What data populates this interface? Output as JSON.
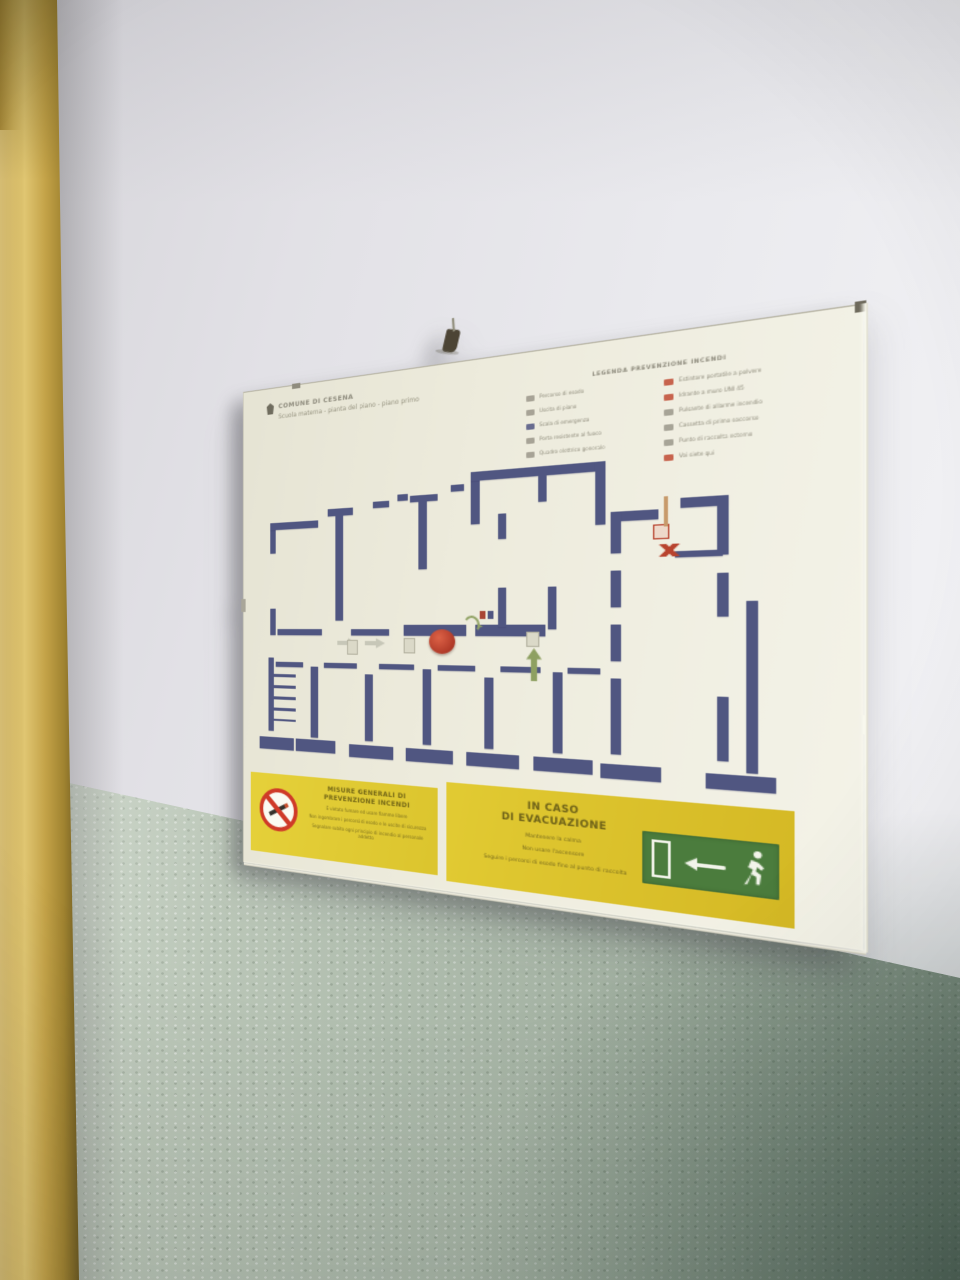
{
  "poster": {
    "title_line1": "COMUNE DI CESENA",
    "title_line2": "Scuola materna - pianta del piano - piano primo"
  },
  "legend": {
    "header": "LEGENDA PREVENZIONE INCENDI",
    "left_items": [
      {
        "label": "Percorso di esodo",
        "color": "#9a978a"
      },
      {
        "label": "Uscita di piano",
        "color": "#9a978a"
      },
      {
        "label": "Scala di emergenza",
        "color": "#505681"
      },
      {
        "label": "Porta resistente al fuoco",
        "color": "#9a978a"
      },
      {
        "label": "Quadro elettrico generale",
        "color": "#9a978a"
      }
    ],
    "right_items": [
      {
        "label": "Estintore portatile a polvere",
        "color": "#bf4a33"
      },
      {
        "label": "Idrante a muro UNI 45",
        "color": "#bf4a33"
      },
      {
        "label": "Pulsante di allarme incendio",
        "color": "#9a978a"
      },
      {
        "label": "Cassetta di primo soccorso",
        "color": "#9a978a"
      },
      {
        "label": "Punto di raccolta esterno",
        "color": "#9a978a"
      },
      {
        "label": "Voi siete qui",
        "color": "#bf4a33"
      }
    ]
  },
  "plan": {
    "wall_color": "#505681",
    "walls": [
      [
        14,
        36,
        6,
        30
      ],
      [
        14,
        36,
        52,
        7
      ],
      [
        76,
        26,
        26,
        7
      ],
      [
        84,
        32,
        8,
        100
      ],
      [
        122,
        22,
        16,
        6
      ],
      [
        146,
        17,
        10,
        6
      ],
      [
        158,
        19,
        26,
        6
      ],
      [
        166,
        24,
        8,
        62
      ],
      [
        196,
        12,
        12,
        6
      ],
      [
        214,
        2,
        8,
        46
      ],
      [
        214,
        2,
        112,
        8
      ],
      [
        318,
        2,
        8,
        52
      ],
      [
        238,
        40,
        7,
        22
      ],
      [
        272,
        10,
        7,
        22
      ],
      [
        14,
        120,
        6,
        26
      ],
      [
        22,
        140,
        48,
        6
      ],
      [
        100,
        140,
        38,
        6
      ],
      [
        152,
        136,
        58,
        10
      ],
      [
        218,
        136,
        60,
        10
      ],
      [
        238,
        104,
        7,
        34
      ],
      [
        280,
        104,
        7,
        36
      ],
      [
        12,
        168,
        6,
        72
      ],
      [
        2,
        246,
        38,
        12
      ],
      [
        58,
        176,
        8,
        68
      ],
      [
        42,
        246,
        42,
        12
      ],
      [
        114,
        182,
        8,
        62
      ],
      [
        98,
        248,
        44,
        12
      ],
      [
        170,
        176,
        8,
        68
      ],
      [
        154,
        248,
        44,
        12
      ],
      [
        226,
        182,
        8,
        62
      ],
      [
        210,
        248,
        46,
        12
      ],
      [
        284,
        176,
        8,
        68
      ],
      [
        268,
        248,
        48,
        12
      ],
      [
        20,
        172,
        30,
        5
      ],
      [
        72,
        172,
        34,
        5
      ],
      [
        128,
        172,
        34,
        5
      ],
      [
        184,
        172,
        34,
        5
      ],
      [
        240,
        172,
        34,
        5
      ],
      [
        296,
        172,
        26,
        5
      ],
      [
        330,
        44,
        36,
        8
      ],
      [
        330,
        44,
        8,
        34
      ],
      [
        382,
        36,
        34,
        8
      ],
      [
        408,
        36,
        8,
        46
      ],
      [
        330,
        92,
        8,
        30
      ],
      [
        408,
        96,
        8,
        34
      ],
      [
        330,
        136,
        8,
        30
      ],
      [
        378,
        78,
        34,
        5
      ],
      [
        330,
        180,
        8,
        62
      ],
      [
        322,
        250,
        46,
        12
      ],
      [
        408,
        192,
        8,
        50
      ],
      [
        400,
        252,
        48,
        12
      ],
      [
        428,
        118,
        8,
        132
      ]
    ],
    "symbols": [
      {
        "type": "arrow-right",
        "x": 86,
        "y": 148,
        "w": 20,
        "h": 10
      },
      {
        "type": "arrow-right",
        "x": 114,
        "y": 148,
        "w": 20,
        "h": 10
      },
      {
        "type": "red-badge",
        "x": 176,
        "y": 140,
        "w": 24,
        "h": 22
      },
      {
        "type": "curve-arrow",
        "x": 208,
        "y": 128,
        "w": 14,
        "h": 16
      },
      {
        "type": "up-arrow",
        "x": 262,
        "y": 156,
        "w": 13,
        "h": 28
      },
      {
        "type": "stairs",
        "x": 18,
        "y": 184,
        "w": 24,
        "h": 46
      },
      {
        "type": "red-box",
        "x": 362,
        "y": 56,
        "w": 12,
        "h": 12
      },
      {
        "type": "tan-pipe",
        "x": 370,
        "y": 34,
        "w": 3,
        "h": 24
      },
      {
        "type": "red-x",
        "x": 366,
        "y": 72,
        "w": 16,
        "h": 10
      },
      {
        "type": "mini-glyphs",
        "x": 222,
        "y": 124,
        "w": 16,
        "h": 7
      },
      {
        "type": "light-box",
        "x": 96,
        "y": 150,
        "w": 11,
        "h": 14
      },
      {
        "type": "light-box",
        "x": 152,
        "y": 148,
        "w": 11,
        "h": 14
      },
      {
        "type": "light-box",
        "x": 262,
        "y": 142,
        "w": 11,
        "h": 13
      }
    ]
  },
  "notices": {
    "left": {
      "heading1": "MISURE GENERALI DI",
      "heading2": "PREVENZIONE INCENDI",
      "paragraphs": [
        "È vietato fumare ed usare fiamme libere",
        "Non ingombrare i percorsi di esodo e le uscite di sicurezza",
        "Segnalare subito ogni principio di incendio al personale addetto"
      ]
    },
    "right": {
      "heading1": "IN CASO",
      "heading2": "DI EVACUAZIONE",
      "lines": [
        "Mantenere la calma",
        "Non usare l'ascensore",
        "Seguire i percorsi di esodo fino al punto di raccolta"
      ]
    }
  },
  "colors": {
    "accent_yellow": "#e0c933",
    "plan_wall_blue": "#505681",
    "exit_green": "#4b7c3d",
    "prohibition_red": "#cf3a28",
    "frame_gold": "#c4a348"
  }
}
